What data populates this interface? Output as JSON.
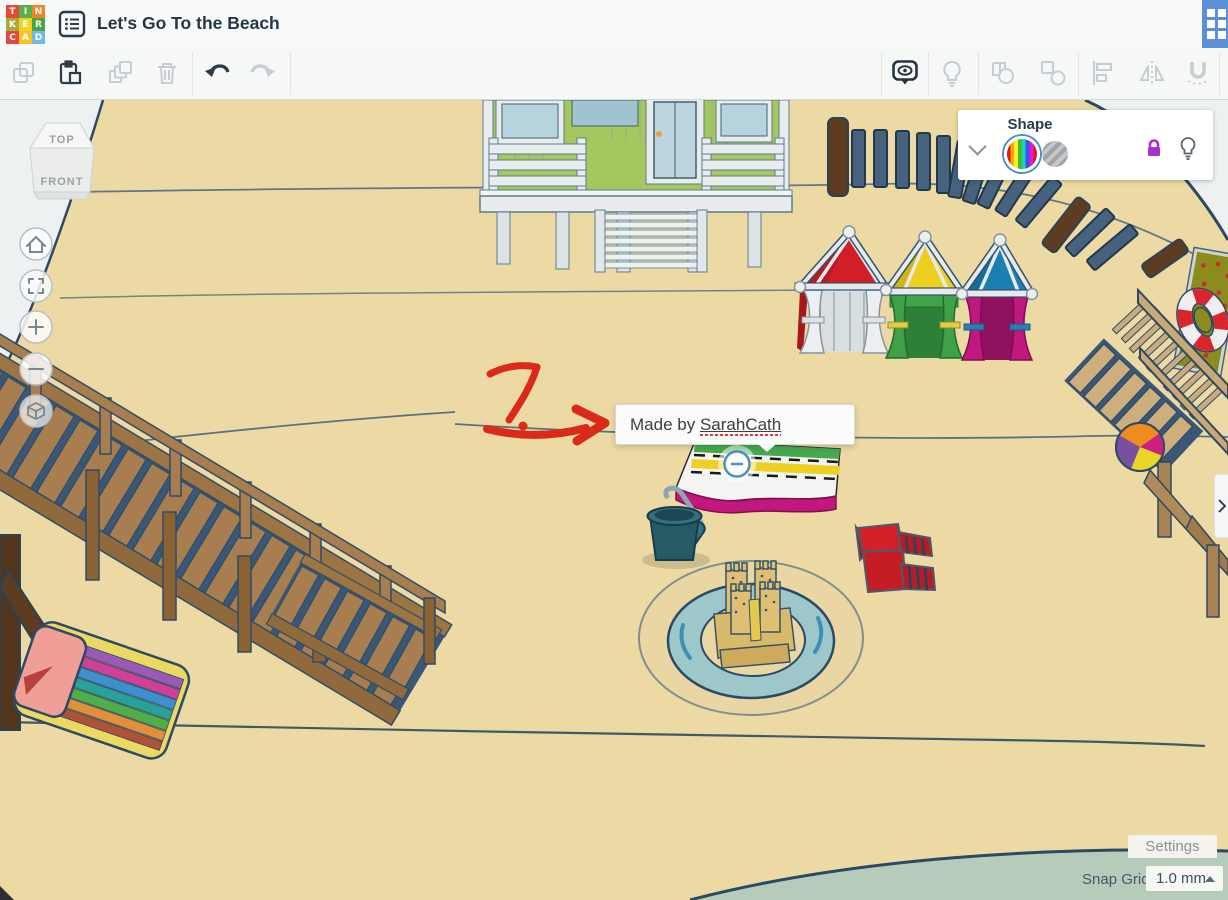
{
  "header": {
    "title": "Let's Go To the Beach",
    "logo_letters": [
      "T",
      "I",
      "N",
      "K",
      "E",
      "R",
      "C",
      "A",
      "D"
    ],
    "logo_colors": [
      "#e44a33",
      "#56b14c",
      "#f08228",
      "#a8ab3a",
      "#f6d020",
      "#47a83f",
      "#e2483d",
      "#f6c51f",
      "#74b8e6"
    ]
  },
  "toolbar": {
    "left_icons": [
      "copy",
      "paste",
      "duplicate",
      "delete",
      "undo",
      "redo"
    ],
    "right_icons": [
      "show-all",
      "light",
      "group",
      "ungroup",
      "align",
      "mirror",
      "magnet"
    ]
  },
  "shape_panel": {
    "title": "Shape"
  },
  "view_cube": {
    "top": "TOP",
    "front": "FRONT"
  },
  "tooltip": {
    "prefix": "Made by ",
    "author": "SarahCath"
  },
  "annotation": {
    "label": "7."
  },
  "footer": {
    "settings": "Settings",
    "snap_grid_label": "Snap Grid",
    "snap_grid_value": "1.0 mm"
  },
  "colors": {
    "sand": "#ecd9a4",
    "water": "#b7cbbb",
    "accent_blue": "#5b8fd9",
    "lock_purple": "#aa2fd0",
    "selection_ring": "#4a90c4",
    "annotation_red": "#d92a1a"
  }
}
